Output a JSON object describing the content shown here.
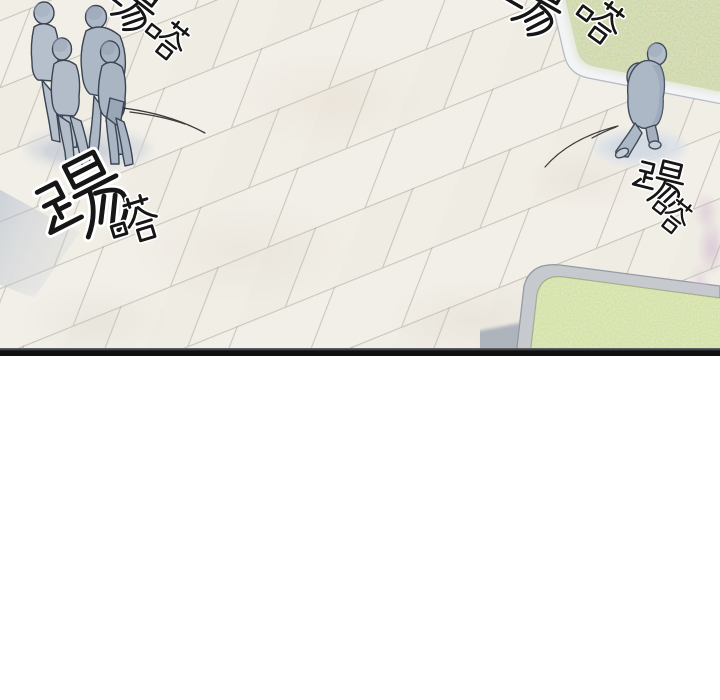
{
  "panel": {
    "sfx": [
      {
        "text": "踢嗒",
        "meaning": "tap-tap footstep sound",
        "position": "top-left",
        "cut_off": "top edge"
      },
      {
        "text": "踢嗒",
        "meaning": "tap-tap footstep sound",
        "position": "mid-left-large"
      },
      {
        "text": "踢嗒",
        "meaning": "tap-tap footstep sound",
        "position": "top-right",
        "cut_off": "top edge"
      },
      {
        "text": "踢嗒",
        "meaning": "tap-tap footstep sound",
        "position": "right-middle"
      }
    ],
    "scene": {
      "pedestrian_group_count": "4",
      "lone_pedestrian_count": "1",
      "ground": "light stone tile plaza, diagonal running-bond pattern",
      "grass_patches": "2 rounded-corner lawn beds with curbs (top-right, bottom-right)"
    },
    "colors": {
      "floor": "#f1eee7",
      "grout": "#968e7d",
      "grass_top_right": "#9fae77",
      "grass_bottom_right": "#a9c36f",
      "curb_top_right": "#f2f4f6",
      "curb_bottom_right": "#c6c9ce",
      "figure_fill": "#b0bac7",
      "figure_outline": "#3a4453",
      "sfx_ink": "#161616",
      "sfx_halo": "#ffffff",
      "panel_border": "#101010",
      "gutter": "#ffffff"
    }
  }
}
